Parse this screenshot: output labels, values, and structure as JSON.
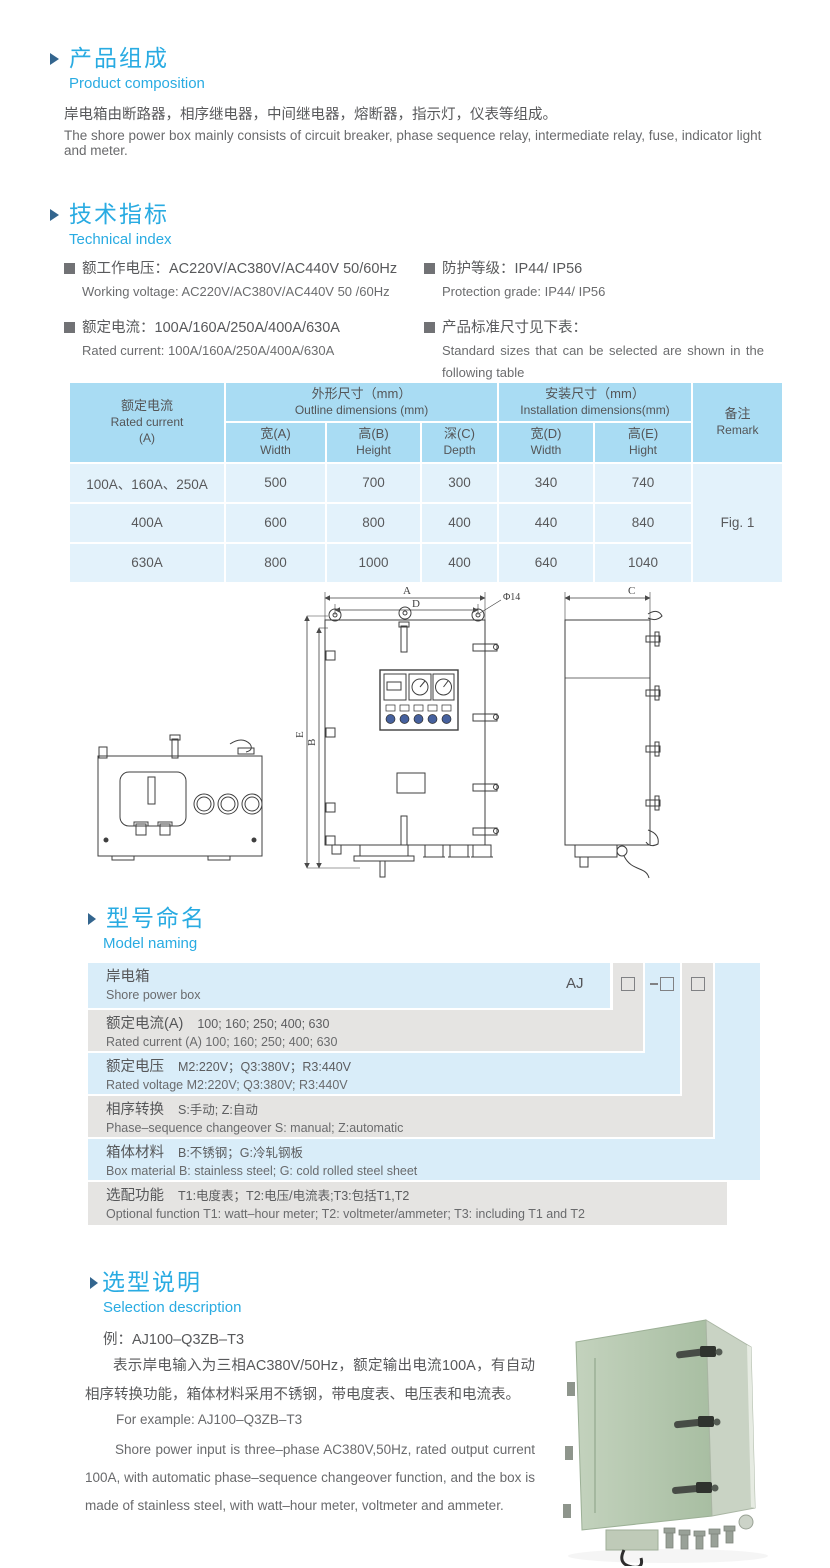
{
  "colors": {
    "accent": "#29abe2",
    "marker": "#33658e",
    "table_header_bg": "#a9dcf3",
    "table_body_bg": "#e3f2fb",
    "band_blue": "#d9edf9",
    "band_gray": "#e5e4e2"
  },
  "composition": {
    "title_zh": "产品组成",
    "title_en": "Product  composition",
    "body_zh": "岸电箱由断路器，相序继电器，中间继电器，熔断器，指示灯，仪表等组成。",
    "body_en": "The shore power box mainly consists of circuit breaker, phase sequence relay, intermediate relay, fuse, indicator light and meter."
  },
  "technical": {
    "title_zh": "技术指标",
    "title_en": "Technical index",
    "items": [
      {
        "zh": "额工作电压：AC220V/AC380V/AC440V  50/60Hz",
        "en": "Working voltage: AC220V/AC380V/AC440V 50 /60Hz"
      },
      {
        "zh": "额定电流：100A/160A/250A/400A/630A",
        "en": "Rated current: 100A/160A/250A/400A/630A"
      },
      {
        "zh": "防护等级：IP44/ IP56",
        "en": "Protection grade: IP44/ IP56"
      },
      {
        "zh": "产品标准尺寸见下表：",
        "en": "Standard sizes that can be selected are shown in the following table"
      }
    ]
  },
  "dim_table": {
    "rated_current_zh": "额定电流",
    "rated_current_en": "Rated current",
    "rated_current_unit": "(A)",
    "outline_zh": "外形尺寸（mm）",
    "outline_en": "Outline dimensions (mm)",
    "install_zh": "安装尺寸（mm）",
    "install_en": "Installation dimensions(mm)",
    "remark_zh": "备注",
    "remark_en": "Remark",
    "subcols": [
      {
        "zh": "宽(A)",
        "en": "Width"
      },
      {
        "zh": "高(B)",
        "en": "Height"
      },
      {
        "zh": "深(C)",
        "en": "Depth"
      },
      {
        "zh": "宽(D)",
        "en": "Width"
      },
      {
        "zh": "高(E)",
        "en": "Hight"
      }
    ],
    "rows": [
      {
        "current": "100A、160A、250A",
        "w": "500",
        "h": "700",
        "d": "300",
        "iw": "340",
        "ih": "740"
      },
      {
        "current": "400A",
        "w": "600",
        "h": "800",
        "d": "400",
        "iw": "440",
        "ih": "840"
      },
      {
        "current": "630A",
        "w": "800",
        "h": "1000",
        "d": "400",
        "iw": "640",
        "ih": "1040"
      }
    ],
    "remark_value": "Fig. 1"
  },
  "drawing": {
    "labels": {
      "a": "A",
      "b": "B",
      "c": "C",
      "d": "D",
      "e": "E",
      "hole": "Φ14"
    }
  },
  "model": {
    "title_zh": "型号命名",
    "title_en": "Model naming",
    "prefix": "AJ",
    "rows": [
      {
        "label_zh": "岸电箱",
        "value_zh": "",
        "label_en": "Shore power box",
        "value_en": ""
      },
      {
        "label_zh": "额定电流(A)",
        "value_zh": "100; 160; 250; 400; 630",
        "label_en": "Rated current (A)",
        "value_en": "100; 160; 250; 400; 630"
      },
      {
        "label_zh": "额定电压",
        "value_zh": "M2:220V；Q3:380V；R3:440V",
        "label_en": "Rated voltage",
        "value_en": "M2:220V;  Q3:380V;  R3:440V"
      },
      {
        "label_zh": "相序转换",
        "value_zh": "S:手动; Z:自动",
        "label_en": "Phase–sequence changeover",
        "value_en": "S: manual;  Z:automatic"
      },
      {
        "label_zh": "箱体材料",
        "value_zh": "B:不锈钢；G:冷轧钢板",
        "label_en": "Box material",
        "value_en": "B: stainless steel; G: cold rolled steel sheet"
      },
      {
        "label_zh": "选配功能",
        "value_zh": "T1:电度表；T2:电压/电流表;T3:包括T1,T2",
        "label_en": "Optional function",
        "value_en": "T1: watt–hour meter; T2: voltmeter/ammeter; T3: including T1 and T2"
      }
    ]
  },
  "selection": {
    "title_zh": "选型说明",
    "title_en": "Selection description",
    "example_zh": "例：AJ100–Q3ZB–T3",
    "para_zh": "表示岸电输入为三相AC380V/50Hz，额定输出电流100A，有自动相序转换功能，箱体材料采用不锈钢，带电度表、电压表和电流表。",
    "example_en": "For example: AJ100–Q3ZB–T3",
    "para_en": "Shore power input is three–phase AC380V,50Hz, rated output current 100A, with automatic phase–sequence changeover function, and the box is made of stainless steel, with watt–hour meter, voltmeter and ammeter."
  }
}
